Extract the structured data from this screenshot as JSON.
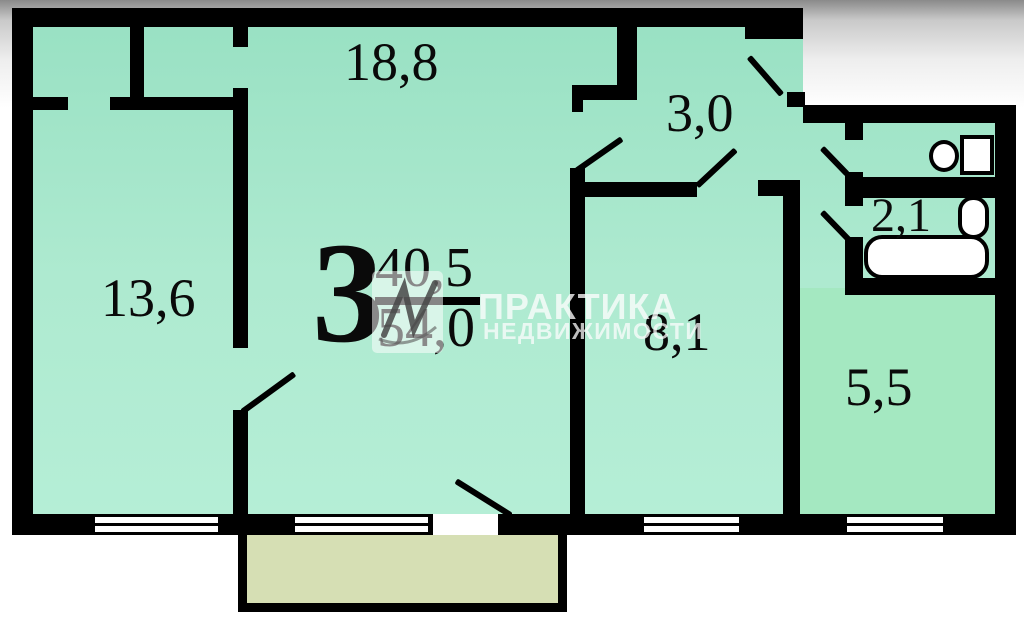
{
  "floor_plan": {
    "summary": {
      "rooms_count": "3",
      "living_area": "40,5",
      "total_area": "54,0"
    },
    "rooms": {
      "living_room": "18,8",
      "bedroom_left": "13,6",
      "hallway": "3,0",
      "bedroom_right": "8,1",
      "bathroom": "2,1",
      "kitchen": "5,5"
    },
    "watermark": {
      "brand": "ПРАКТИКА",
      "subtitle": "НЕДВИЖИМОСТИ"
    },
    "colors": {
      "wall": "#000000",
      "room_fill_top": "#97e0c2",
      "room_fill_bottom": "#b8f0d9",
      "kitchen_fill": "#a4e8c1",
      "balcony_fill": "#d6dfb4",
      "background_top": "#8a8a8a",
      "background": "#ffffff"
    }
  }
}
